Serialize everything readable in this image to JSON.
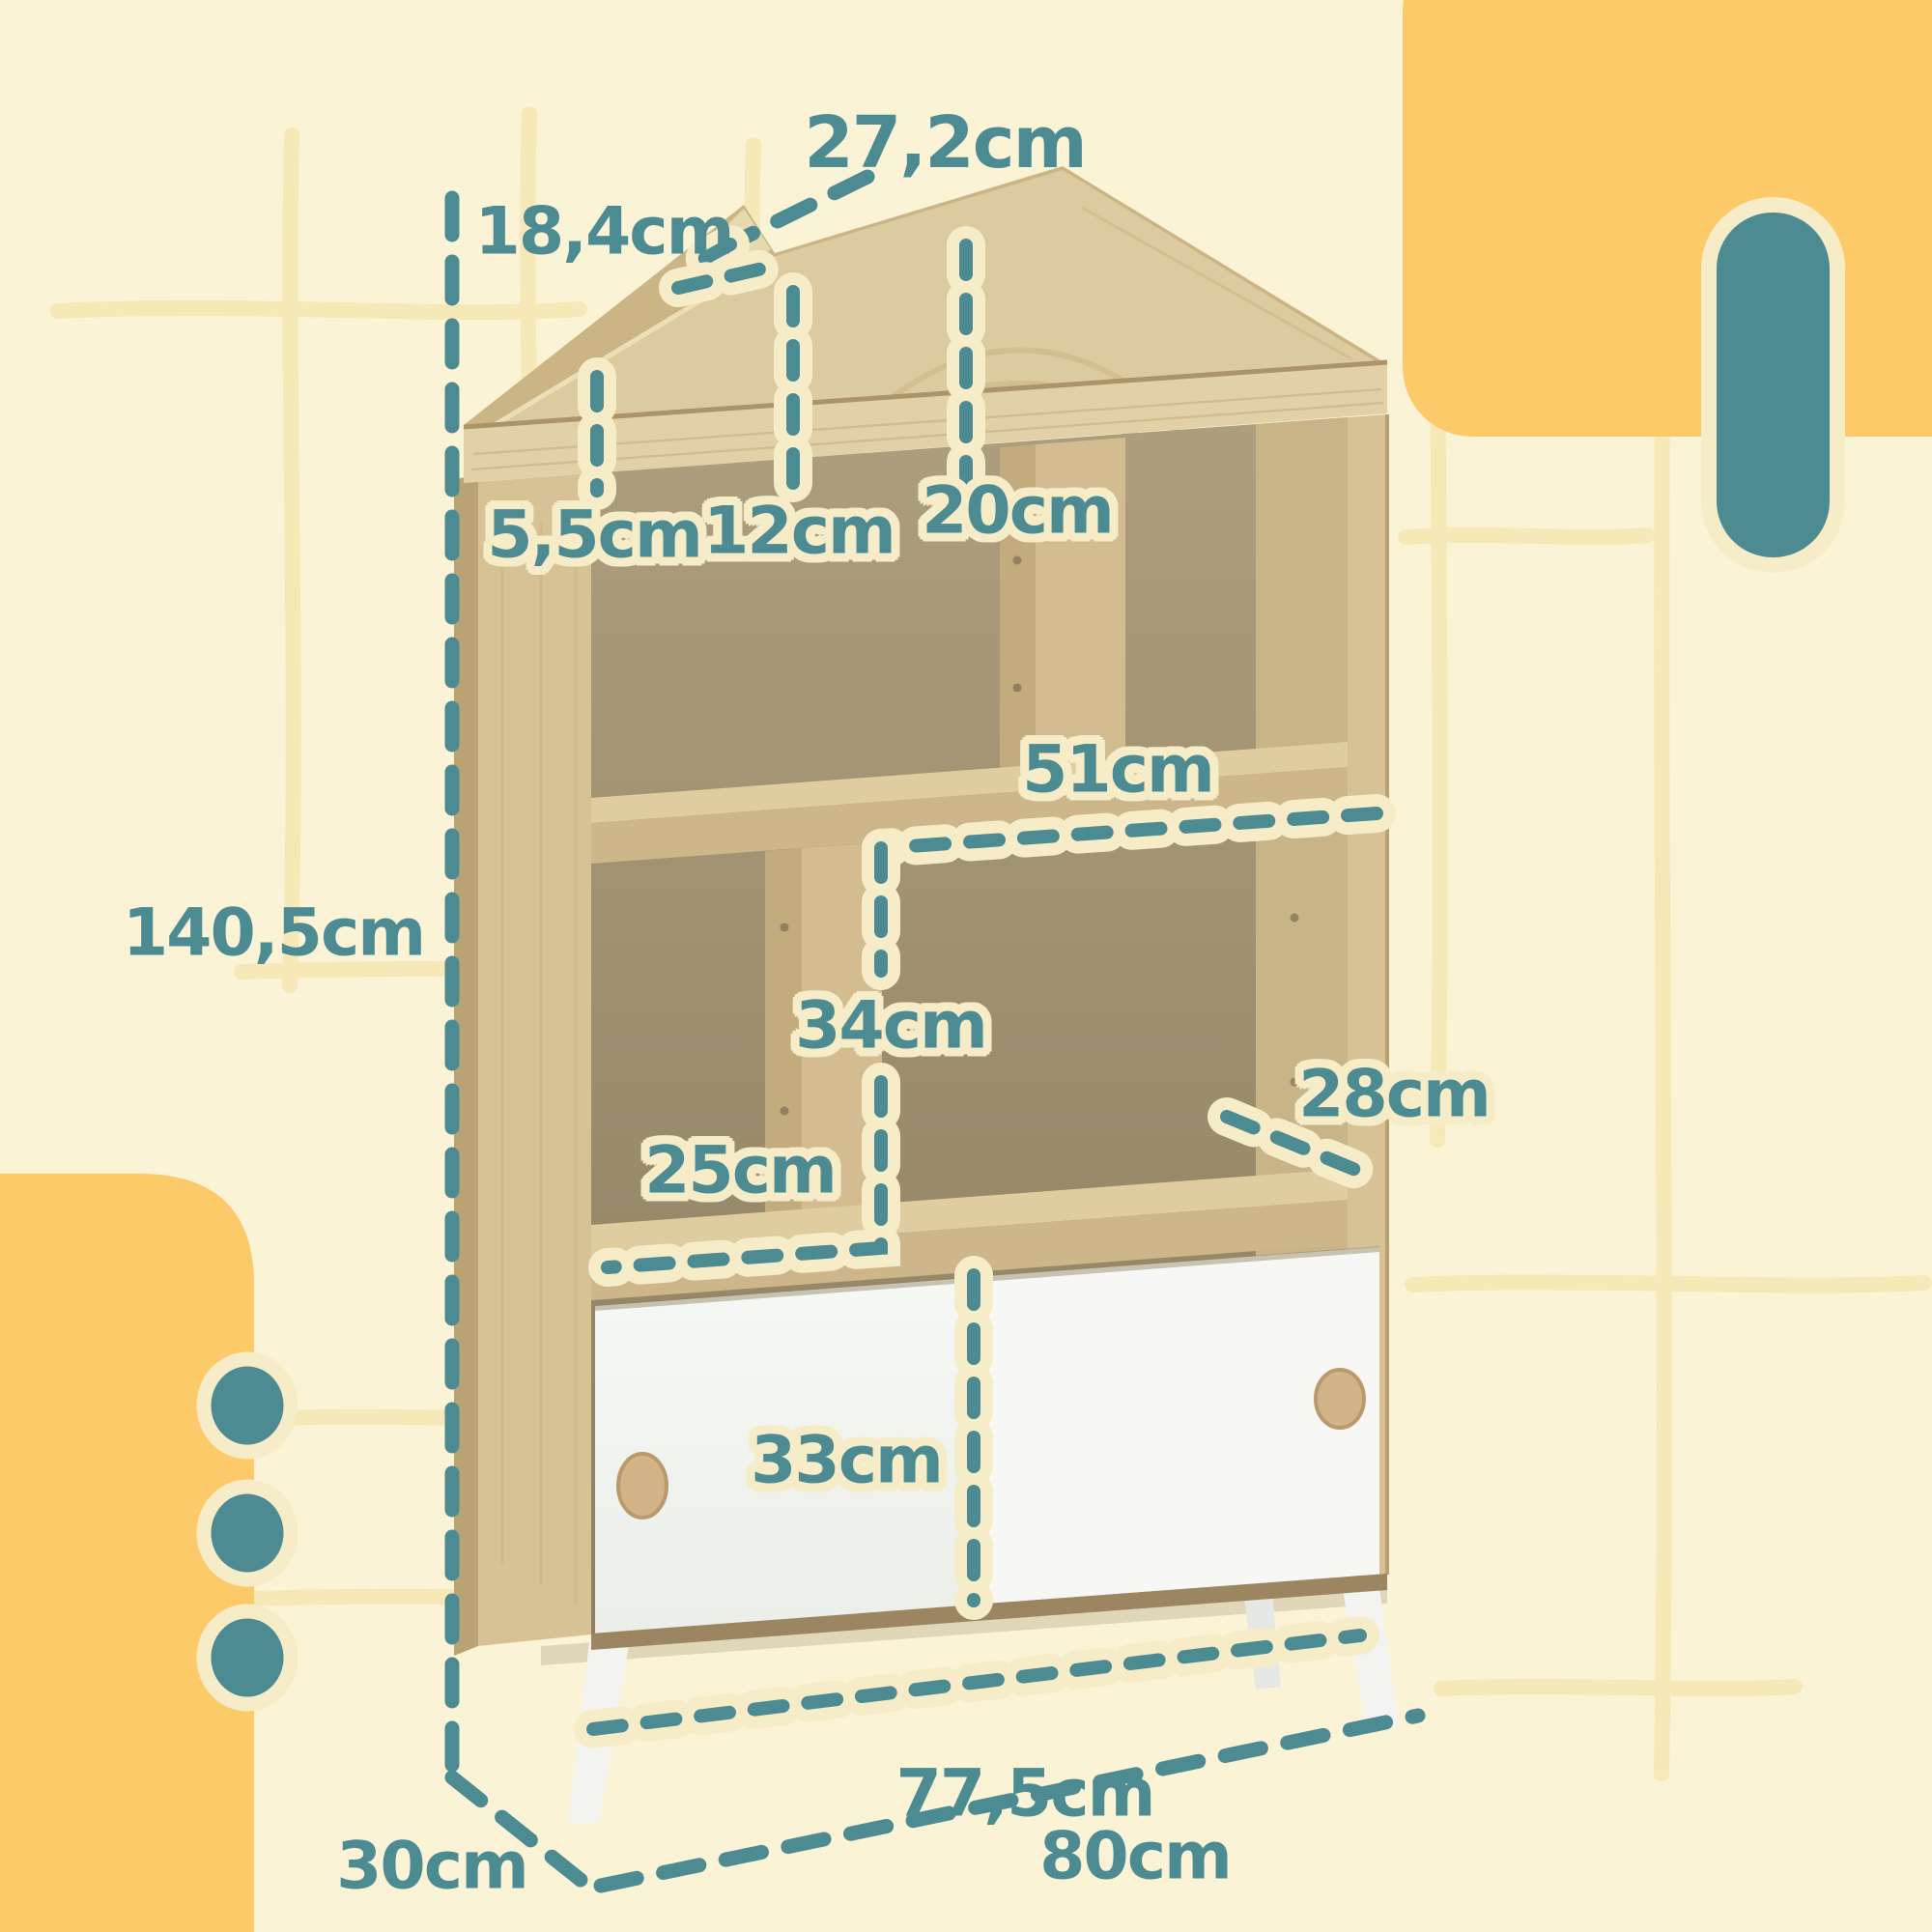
{
  "figure": {
    "kind": "product-dimension-infographic",
    "subject": "house-shaped kids bookcase with two sliding doors, drawn with measurement callouts"
  },
  "labels": [
    {
      "id": "roof-edge",
      "text": "27,2cm"
    },
    {
      "id": "roof-step",
      "text": "18,4cm"
    },
    {
      "id": "top-board",
      "text": "5,5cm"
    },
    {
      "id": "roof-pocket",
      "text": "12cm"
    },
    {
      "id": "top-cubby",
      "text": "20cm"
    },
    {
      "id": "shelf-width",
      "text": "51cm"
    },
    {
      "id": "total-height",
      "text": "140,5cm"
    },
    {
      "id": "mid-cubby",
      "text": "34cm"
    },
    {
      "id": "left-cubby",
      "text": "25cm"
    },
    {
      "id": "right-cubby",
      "text": "28cm"
    },
    {
      "id": "door-height",
      "text": "33cm"
    },
    {
      "id": "door-span",
      "text": "77,5cm"
    },
    {
      "id": "depth",
      "text": "30cm"
    },
    {
      "id": "total-width",
      "text": "80cm"
    }
  ],
  "colors": {
    "teal_accent": "#4d8b93",
    "cream_outline": "#f6edc8",
    "background": "#fbf3d6",
    "grid_line": "#f7e8b8",
    "accent_yellow": "#fcca68",
    "wood_light": "#ddcba0",
    "wood_medium": "#cdb78a",
    "wood_dark": "#b7a173",
    "interior": "#a99b7a",
    "door_white": "#f4f6f3"
  },
  "icons": [
    {
      "name": "accent-capsule",
      "shape": "teal rounded pill with cream ring, top right"
    },
    {
      "name": "accent-dot",
      "shape": "teal circle with cream ring, three on bottom-left yellow band"
    }
  ]
}
